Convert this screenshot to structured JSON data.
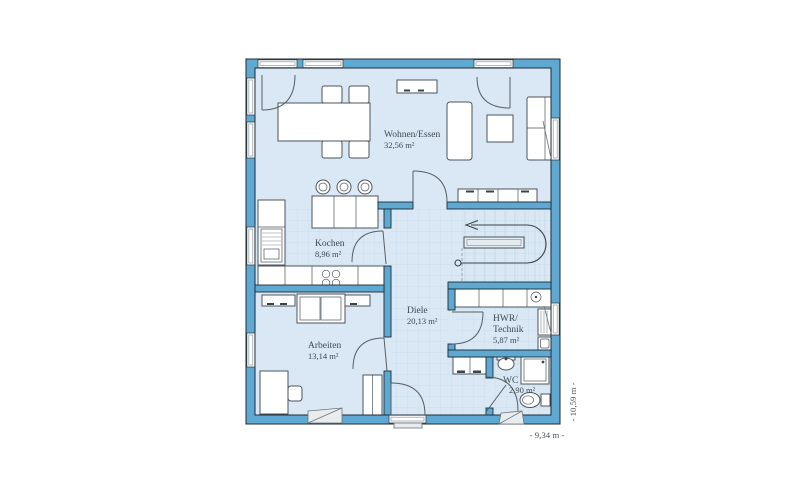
{
  "plan": {
    "rooms": [
      {
        "name": "Wohnen/Essen",
        "area": "32,56 m²"
      },
      {
        "name": "Kochen",
        "area": "8,96 m²"
      },
      {
        "name": "Diele",
        "area": "20,13 m²"
      },
      {
        "name": "Arbeiten",
        "area": "13,14 m²"
      },
      {
        "name": "HWR/",
        "name2": "Technik",
        "area": "5,87 m²"
      },
      {
        "name": "WC",
        "area": "2,90 m²"
      }
    ],
    "dimensions": {
      "width": "- 9,34 m -",
      "height": "- 10,59 m -"
    },
    "colors": {
      "wall": "#5fa8d1",
      "floor": "#d9e8f4",
      "tile_line": "#c6dbeb",
      "outline": "#1c2b33",
      "furniture_stroke": "#4d565c",
      "text": "#3d4a54"
    }
  }
}
